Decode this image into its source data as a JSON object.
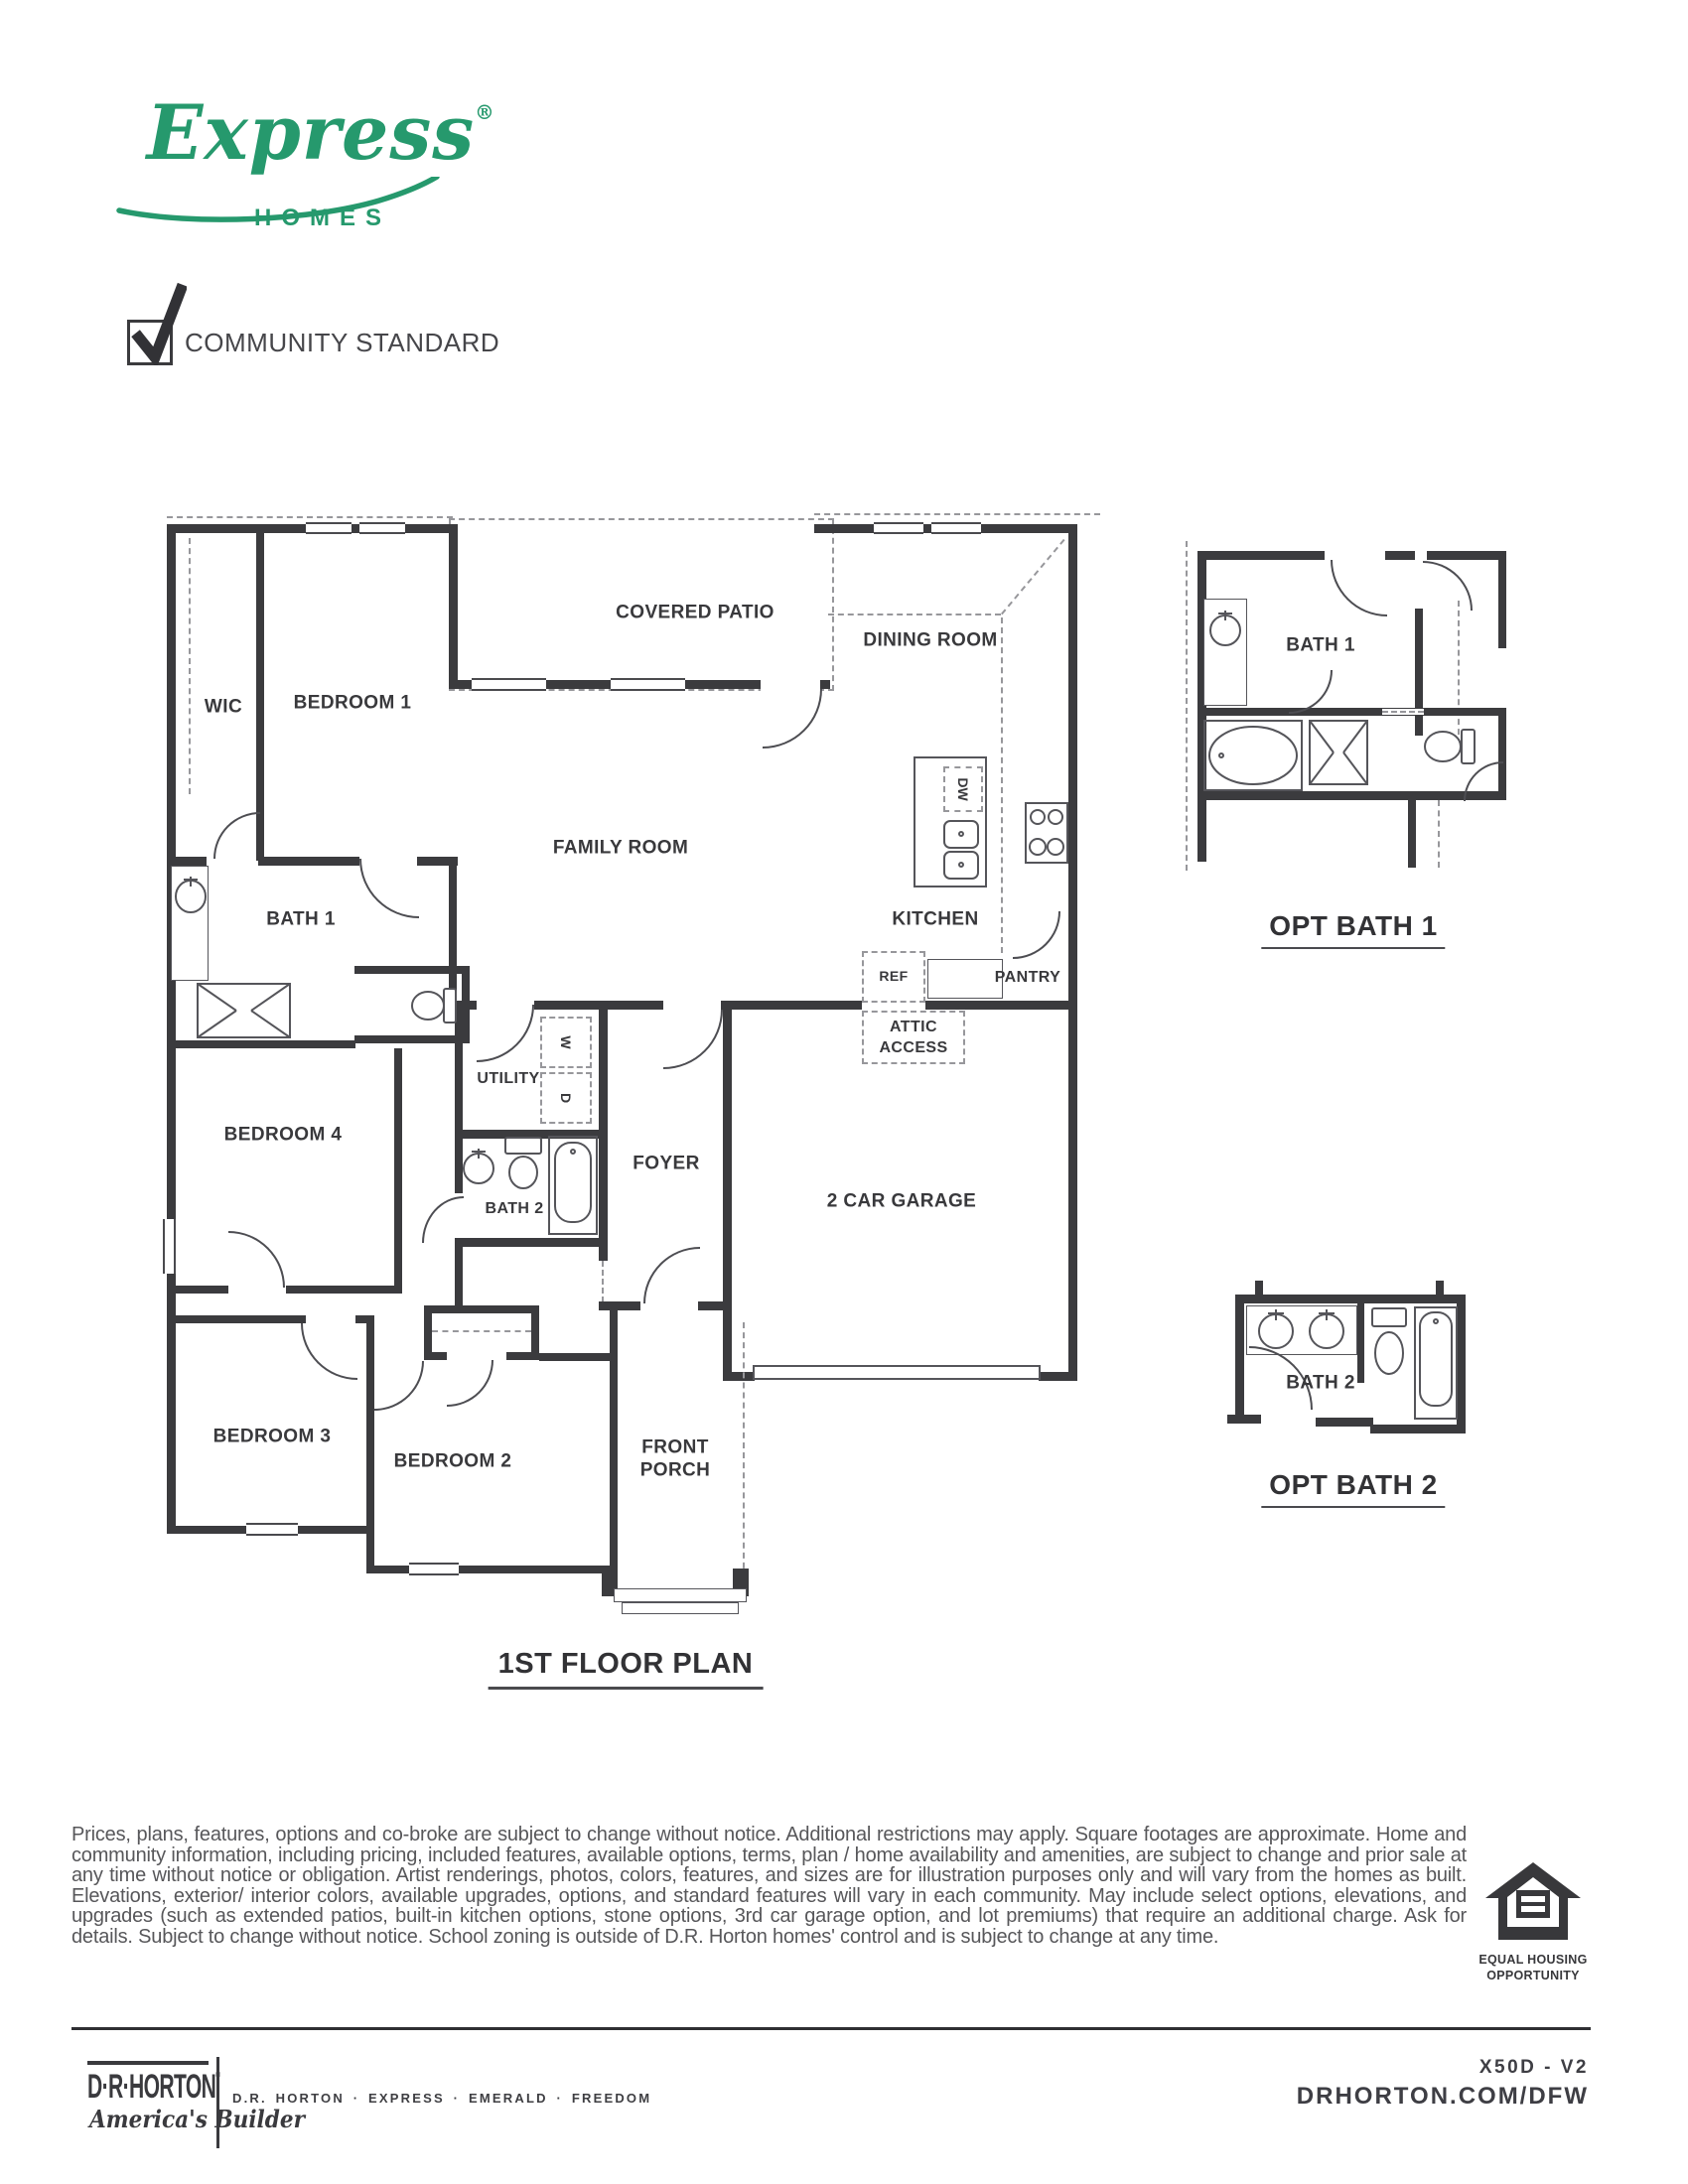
{
  "brand": {
    "script": "Express",
    "reg": "®",
    "sub": "HOMES",
    "green": "#26996d"
  },
  "header": {
    "community_standard": "COMMUNITY STANDARD"
  },
  "plan": {
    "title": "1ST FLOOR PLAN",
    "rooms": {
      "covered_patio": "COVERED PATIO",
      "dining": "DINING ROOM",
      "wic": "WIC",
      "bedroom1": "BEDROOM 1",
      "family": "FAMILY ROOM",
      "bath1": "BATH 1",
      "kitchen": "KITCHEN",
      "pantry": "PANTRY",
      "ref": "REF",
      "dw": "DW",
      "attic1": "ATTIC",
      "attic2": "ACCESS",
      "utility": "UTILITY",
      "washer": "W",
      "dryer": "D",
      "bedroom4": "BEDROOM 4",
      "foyer": "FOYER",
      "bath2": "BATH 2",
      "garage": "2 CAR GARAGE",
      "bedroom3": "BEDROOM 3",
      "bedroom2": "BEDROOM 2",
      "porch1": "FRONT",
      "porch2": "PORCH"
    }
  },
  "options": {
    "bath1_room": "BATH 1",
    "bath1_caption": "OPT BATH 1",
    "bath2_room": "BATH 2",
    "bath2_caption": "OPT BATH 2"
  },
  "disclaimer": "Prices, plans, features, options and co-broke are subject to change without notice. Additional restrictions may apply.  Square footages are approximate. Home and community information, including pricing, included features, available options, terms, plan / home availability and amenities, are subject to change and prior sale at any time without notice or obligation. Artist renderings, photos, colors, features, and sizes are for illustration purposes only and will vary from the homes as built. Elevations, exterior/ interior colors, available upgrades, options, and standard features will vary in each community. May include select options, elevations, and upgrades (such as extended patios, built-in kitchen options, stone options, 3rd car garage option, and lot premiums) that require an additional charge. Ask for details. Subject to change without notice. School zoning is outside of D.R. Horton homes' control and is subject to change at any time.",
  "footer": {
    "eho1": "EQUAL HOUSING",
    "eho2": "OPPORTUNITY",
    "logo": "D·R·HORTON",
    "logo_reg": "®",
    "tagline": "America's Builder",
    "brands": "D.R. HORTON · EXPRESS · EMERALD · FREEDOM",
    "code": "X50D - V2",
    "site": "DRHORTON.COM/DFW"
  }
}
